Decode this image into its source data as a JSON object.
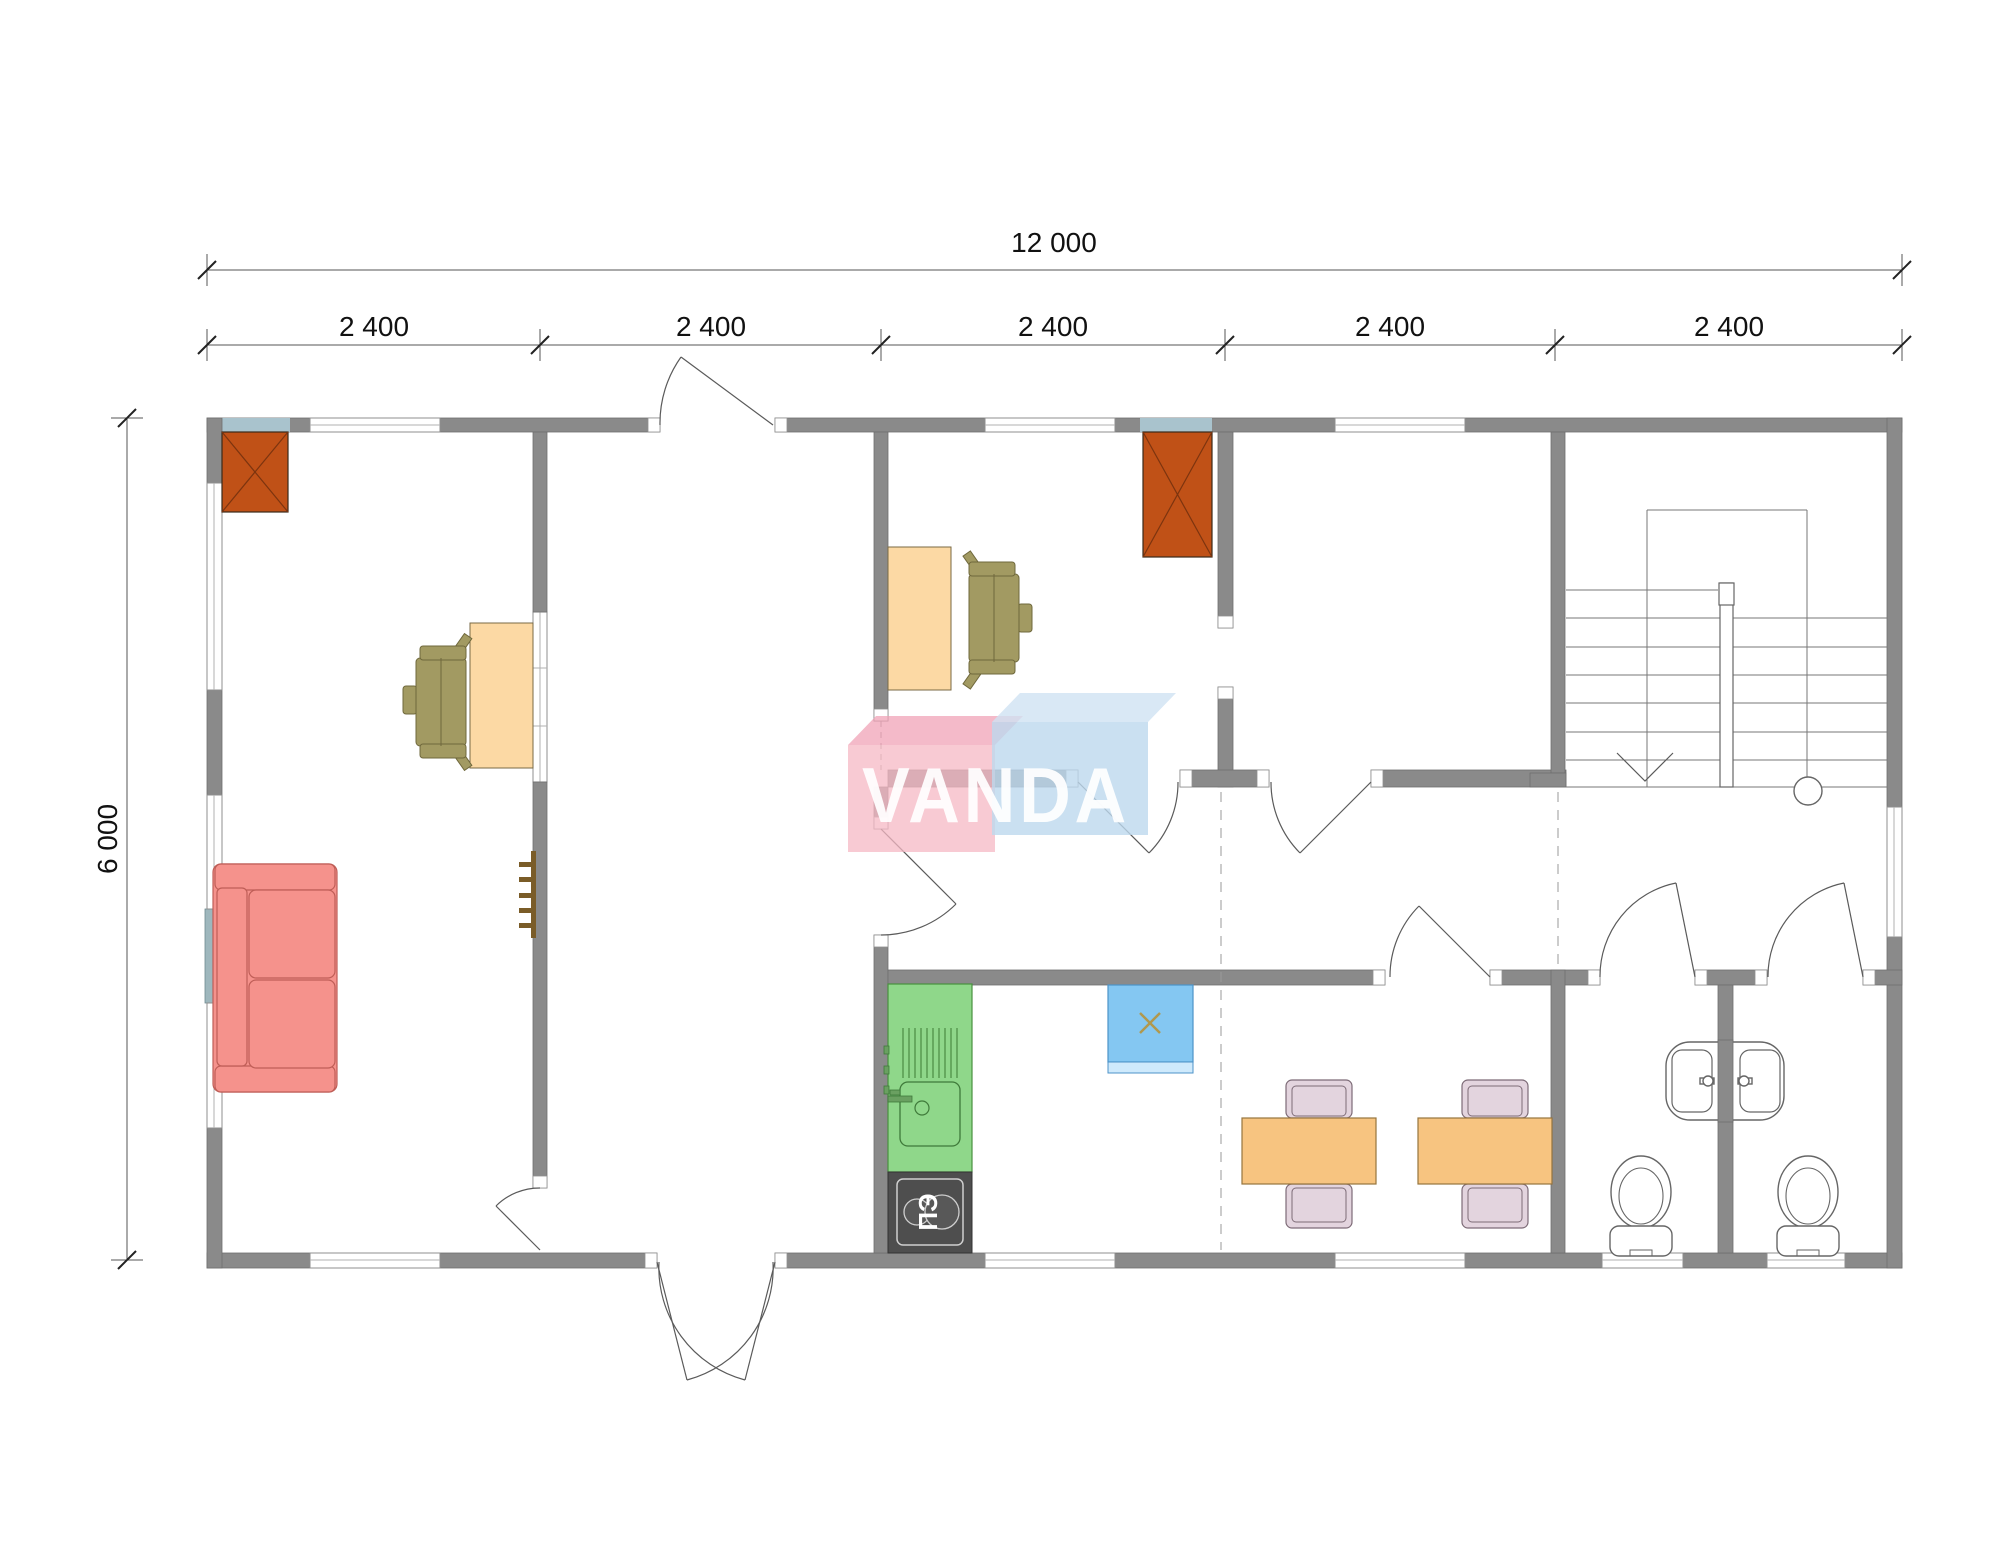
{
  "canvas": {
    "width": 2000,
    "height": 1563,
    "background": "#ffffff"
  },
  "dimensions": {
    "total_width": "12 000",
    "segments": [
      "2 400",
      "2 400",
      "2 400",
      "2 400",
      "2 400"
    ],
    "total_height": "6 000"
  },
  "watermark": {
    "text": "VANDA"
  },
  "kitchen": {
    "stove_label": "ПЭ"
  },
  "colors": {
    "wall": "#8a8a8a",
    "wall_tint": "#a9c3cd",
    "accent_panel": "#9eb7bd",
    "chimney": "#c05117",
    "desk": "#fcd9a4",
    "chair": "#a29a62",
    "sofa": "#f5928c",
    "kitchen_counter": "#8fd78a",
    "stove": "#4e4e4e",
    "water_heater": "#84c7f2",
    "heater_strip": "#cfeafc",
    "dining_table": "#f7c480",
    "dining_chair": "#e3d4de",
    "watermark_pink": "#f6b8c4",
    "watermark_blue": "#bdd8ee",
    "wood": "#7a5c28"
  }
}
